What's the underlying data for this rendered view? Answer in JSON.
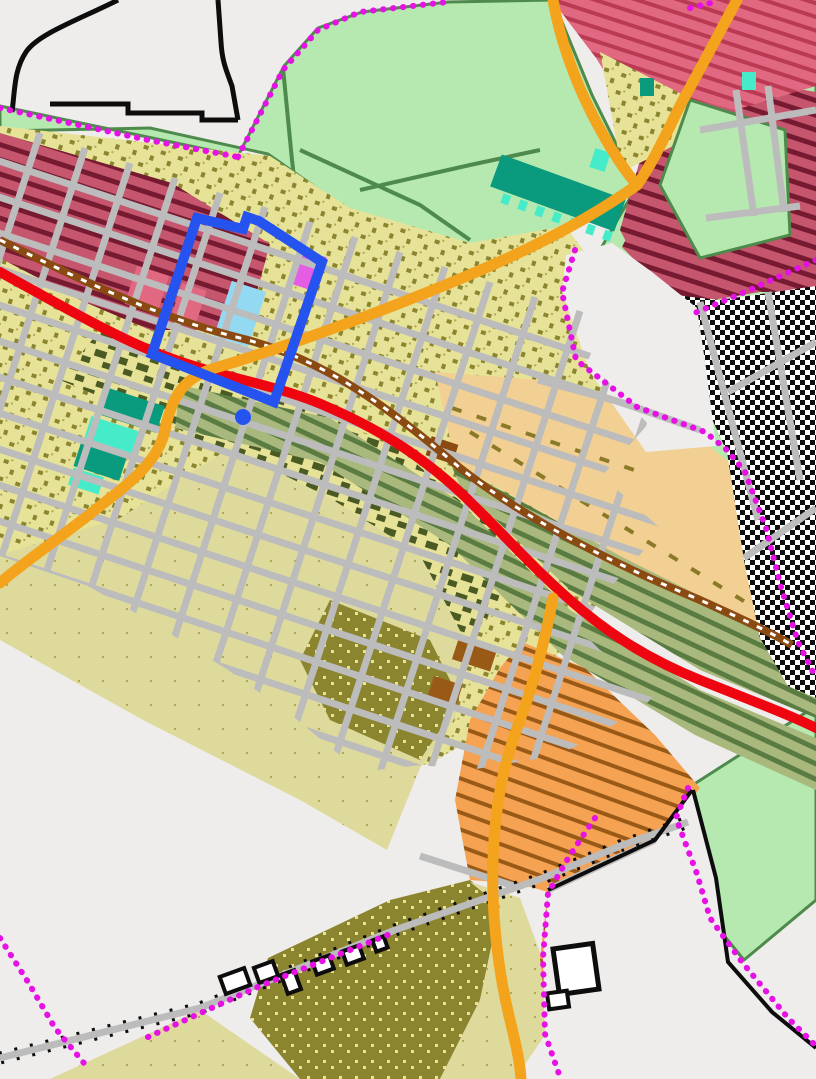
{
  "app": {
    "name": "zoning-map-viewer"
  },
  "map": {
    "kind": "municipal zoning map with selected parcel highlight",
    "colors": {
      "background": "#efedeb",
      "white": "#ffffff",
      "ink": "#0d0d0d",
      "greenbelt": "#b5e9b0",
      "green_border": "#4e8a4c",
      "khaki_parcel": "#e6e298",
      "khaki_mark": "#8b8530",
      "dark_parcel": "#4a5a22",
      "olive": "#8b8530",
      "pale_khaki": "#deda9c",
      "pale_mark": "#b0a855",
      "maroon": "#c5566e",
      "maroon_dark": "#751a30",
      "crimson": "#e06880",
      "crimson_dark": "#b93a52",
      "sage": "#a9b87c",
      "sage_dark": "#5a7c42",
      "tan": "#f2cf92",
      "tan_mark": "#8a7a28",
      "orange_zone": "#f5a352",
      "orange_hatch": "#9a5a17",
      "teal": "#0a9a7e",
      "teal_bright": "#46ecca",
      "light_blue": "#93d9f2",
      "pink_parcel": "#e55ce5",
      "street_gray": "#bcbcbc",
      "road_orange": "#f3a31c",
      "road_red": "#ee0510",
      "rail_brown": "#8a4a12",
      "boundary_magenta": "#e511e5",
      "selection_blue": "#2553f0"
    },
    "selection": {
      "shape": "rotated-rectangle",
      "vertex_dot": true,
      "stroke_px": 10
    },
    "features": {
      "zones": [
        {
          "id": "greenbelt-open-space",
          "color_key": "greenbelt"
        },
        {
          "id": "residential-maroon-hatched",
          "color_key": "maroon"
        },
        {
          "id": "residential-crimson-hatched",
          "color_key": "crimson"
        },
        {
          "id": "urban-khaki-parcels",
          "color_key": "khaki_parcel"
        },
        {
          "id": "olive-speckled-district",
          "color_key": "olive"
        },
        {
          "id": "pale-khaki-district",
          "color_key": "pale_khaki"
        },
        {
          "id": "sage-striped-corridor",
          "color_key": "sage"
        },
        {
          "id": "tan-commercial",
          "color_key": "tan"
        },
        {
          "id": "orange-hatched-district",
          "color_key": "orange_zone"
        },
        {
          "id": "teal-public-parcels",
          "color_key": "teal"
        },
        {
          "id": "black-white-hatched-district",
          "color_key": "ink"
        },
        {
          "id": "light-blue-parcel",
          "color_key": "light_blue"
        },
        {
          "id": "pink-parcel",
          "color_key": "pink_parcel"
        }
      ],
      "roads": [
        {
          "id": "red-highway",
          "color_key": "road_red"
        },
        {
          "id": "orange-arterials",
          "color_key": "road_orange"
        },
        {
          "id": "street-grid",
          "color_key": "street_gray"
        },
        {
          "id": "railroad",
          "color_key": "rail_brown"
        },
        {
          "id": "ticked-rural-road",
          "color_key": "street_gray"
        }
      ],
      "boundaries": [
        {
          "id": "city-limits",
          "style": "dotted",
          "color_key": "boundary_magenta"
        },
        {
          "id": "black-outline-boundaries",
          "style": "solid",
          "color_key": "ink"
        }
      ]
    }
  }
}
